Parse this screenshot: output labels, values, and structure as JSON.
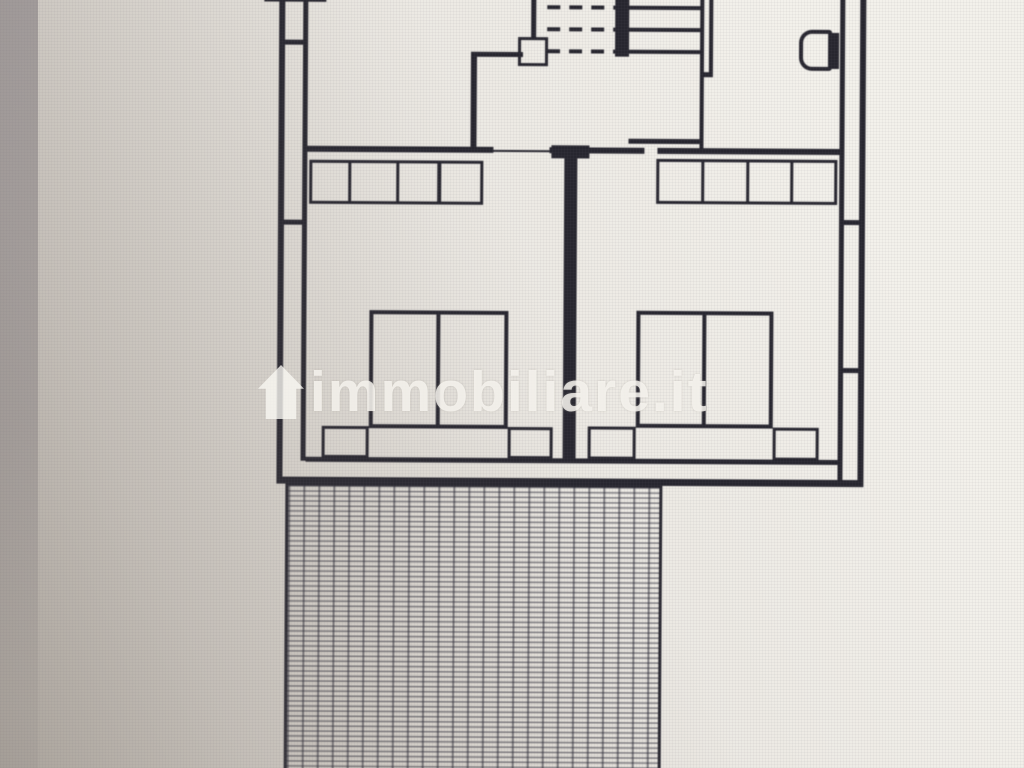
{
  "watermark": {
    "text": "immobiliare.it",
    "icon": "house-icon",
    "color": "rgba(250,248,243,0.80)"
  },
  "photo": {
    "background_light": "#f3f1eb",
    "background_dark": "#c6c0b6",
    "left_band_color": "#80797e"
  },
  "plan": {
    "line_color": "#27262f",
    "hatch_line_color": "rgba(42,42,54,0.55)",
    "solid_rects": [
      {
        "name": "wall-top-cut",
        "x": 262,
        "y": -8,
        "w": 62,
        "h": 11
      },
      {
        "name": "wall-left-outer",
        "x": 277,
        "y": -8,
        "w": 6,
        "h": 487
      },
      {
        "name": "wall-left-inner",
        "x": 301,
        "y": -8,
        "w": 5,
        "h": 470
      },
      {
        "name": "wall-left-tick-top",
        "x": 277,
        "y": 41,
        "w": 29,
        "h": 5
      },
      {
        "name": "wall-left-tick-mid",
        "x": 277,
        "y": 221,
        "w": 29,
        "h": 5
      },
      {
        "name": "wall-closet-vertical",
        "x": 469,
        "y": 52,
        "w": 6,
        "h": 97
      },
      {
        "name": "wall-closet-horizontal",
        "x": 469,
        "y": 52,
        "w": 52,
        "h": 5
      },
      {
        "name": "wall-above-landing-box",
        "x": 529,
        "y": -8,
        "w": 5,
        "h": 46
      },
      {
        "name": "stair-cut-bar",
        "x": 613,
        "y": -8,
        "w": 14,
        "h": 64
      },
      {
        "name": "stair-tread-1",
        "x": 627,
        "y": 5,
        "w": 73,
        "h": 4
      },
      {
        "name": "stair-tread-2",
        "x": 627,
        "y": 27,
        "w": 73,
        "h": 4
      },
      {
        "name": "stair-tread-3",
        "x": 627,
        "y": 49,
        "w": 73,
        "h": 4
      },
      {
        "name": "wall-stair-right-a",
        "x": 698,
        "y": -8,
        "w": 4,
        "h": 156
      },
      {
        "name": "wall-stair-right-b",
        "x": 707,
        "y": -8,
        "w": 4,
        "h": 84
      },
      {
        "name": "wall-stair-right-tick",
        "x": 698,
        "y": 71,
        "w": 13,
        "h": 5
      },
      {
        "name": "wall-stair-bottom",
        "x": 627,
        "y": 138,
        "w": 75,
        "h": 5
      },
      {
        "name": "wall-hall-bottom-left",
        "x": 306,
        "y": 147,
        "w": 186,
        "h": 6
      },
      {
        "name": "door-threshold-left-bedroom",
        "x": 492,
        "y": 150,
        "w": 56,
        "h": 2
      },
      {
        "name": "wall-hall-bottom-mid",
        "x": 548,
        "y": 147,
        "w": 95,
        "h": 6
      },
      {
        "name": "wall-middle-header",
        "x": 550,
        "y": 145,
        "w": 38,
        "h": 13
      },
      {
        "name": "wall-hall-bottom-right",
        "x": 656,
        "y": 147,
        "w": 182,
        "h": 6
      },
      {
        "name": "wall-between-bedrooms",
        "x": 563,
        "y": 153,
        "w": 13,
        "h": 309
      },
      {
        "name": "wardrobe-left-divider-1",
        "x": 347,
        "y": 161,
        "w": 3,
        "h": 44
      },
      {
        "name": "wardrobe-left-divider-2",
        "x": 395,
        "y": 161,
        "w": 3,
        "h": 44
      },
      {
        "name": "wardrobe-left-divider-3",
        "x": 436,
        "y": 161,
        "w": 4,
        "h": 44
      },
      {
        "name": "wardrobe-right-divider-1",
        "x": 700,
        "y": 158,
        "w": 3,
        "h": 45
      },
      {
        "name": "wardrobe-right-divider-2",
        "x": 745,
        "y": 158,
        "w": 3,
        "h": 45
      },
      {
        "name": "wardrobe-right-divider-3",
        "x": 789,
        "y": 158,
        "w": 3,
        "h": 45
      },
      {
        "name": "bed-left-center-line",
        "x": 436,
        "y": 311,
        "w": 4,
        "h": 118
      },
      {
        "name": "bed-right-center-line",
        "x": 702,
        "y": 310,
        "w": 4,
        "h": 117
      },
      {
        "name": "toilet-tank",
        "x": 827,
        "y": 31,
        "w": 10,
        "h": 36
      },
      {
        "name": "wall-right-inner",
        "x": 838,
        "y": -8,
        "w": 5,
        "h": 489
      },
      {
        "name": "wall-right-outer",
        "x": 858,
        "y": -8,
        "w": 6,
        "h": 493
      },
      {
        "name": "wall-right-tick-top",
        "x": 838,
        "y": 218,
        "w": 26,
        "h": 5
      },
      {
        "name": "wall-right-tick-mid",
        "x": 838,
        "y": 366,
        "w": 26,
        "h": 5
      },
      {
        "name": "wall-bottom-inner",
        "x": 306,
        "y": 458,
        "w": 532,
        "h": 5
      },
      {
        "name": "wall-bottom-outer",
        "x": 277,
        "y": 478,
        "w": 587,
        "h": 7
      }
    ],
    "outline_rects": [
      {
        "name": "stair-landing-box",
        "x": 516,
        "y": 37,
        "w": 30,
        "h": 29,
        "t": 3
      },
      {
        "name": "wardrobe-left",
        "x": 308,
        "y": 161,
        "w": 174,
        "h": 44,
        "t": 3
      },
      {
        "name": "wardrobe-right",
        "x": 655,
        "y": 158,
        "w": 181,
        "h": 45,
        "t": 3
      },
      {
        "name": "bed-left",
        "x": 369,
        "y": 311,
        "w": 139,
        "h": 118,
        "t": 4
      },
      {
        "name": "bed-right",
        "x": 636,
        "y": 310,
        "w": 137,
        "h": 117,
        "t": 4
      },
      {
        "name": "nightstand-left-1",
        "x": 322,
        "y": 427,
        "w": 47,
        "h": 32,
        "t": 3
      },
      {
        "name": "nightstand-left-2",
        "x": 508,
        "y": 427,
        "w": 45,
        "h": 32,
        "t": 3
      },
      {
        "name": "nightstand-right-1",
        "x": 588,
        "y": 426,
        "w": 48,
        "h": 33,
        "t": 3
      },
      {
        "name": "nightstand-right-2",
        "x": 773,
        "y": 426,
        "w": 46,
        "h": 33,
        "t": 3
      },
      {
        "name": "toilet-bowl",
        "x": 797,
        "y": 28,
        "w": 33,
        "h": 41,
        "t": 4,
        "r": "13px 3px 3px 13px"
      }
    ],
    "dashed_rows": [
      {
        "name": "stair-dashed-line-1",
        "x": 545,
        "y": 5,
        "w": 68,
        "h": 4
      },
      {
        "name": "stair-dashed-line-2",
        "x": 545,
        "y": 27,
        "w": 68,
        "h": 4
      },
      {
        "name": "stair-dashed-line-3",
        "x": 545,
        "y": 49,
        "w": 68,
        "h": 4
      }
    ],
    "hatch": {
      "name": "terrace-hatch",
      "x": 286,
      "y": 483,
      "w": 377,
      "h": 300
    }
  }
}
